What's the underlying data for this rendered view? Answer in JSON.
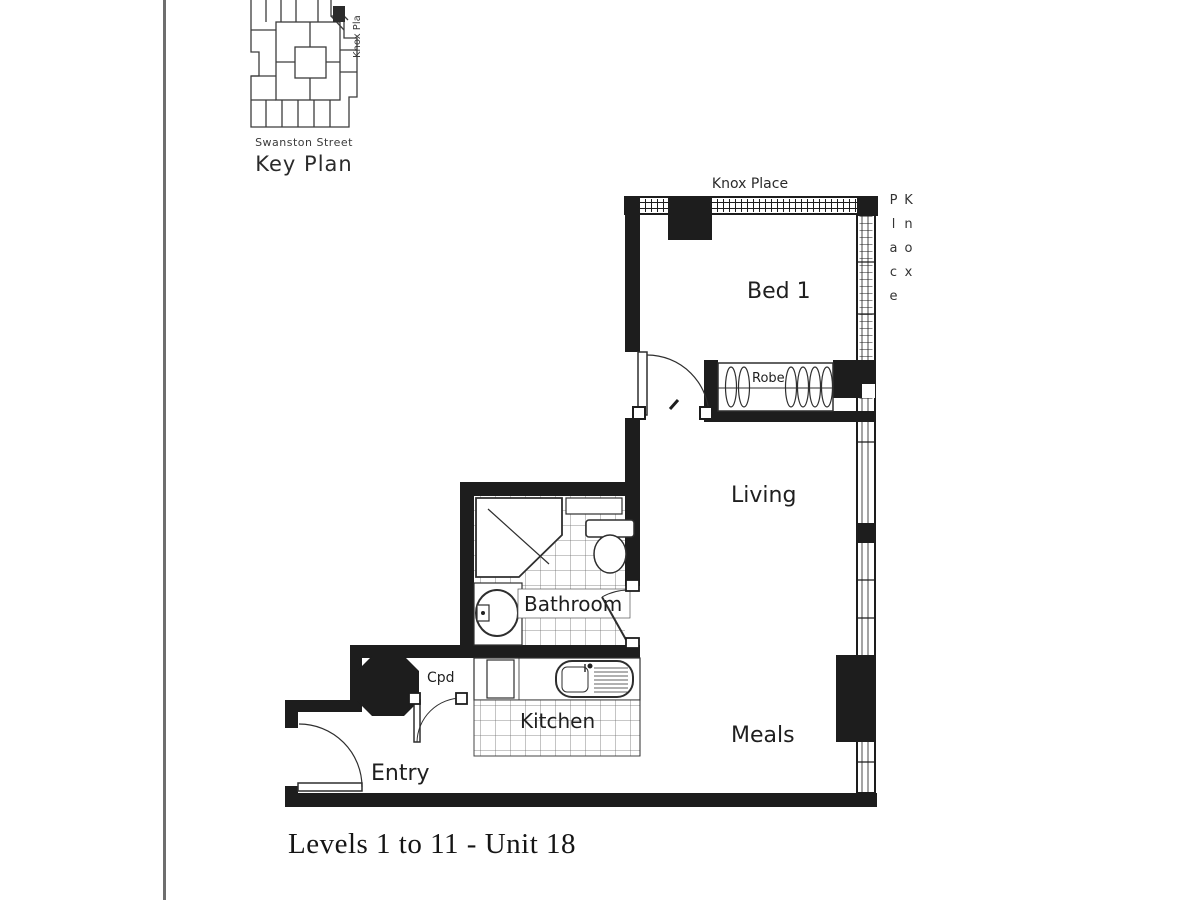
{
  "document": {
    "caption": "Levels 1 to 11 - Unit 18"
  },
  "key_plan": {
    "title": "Key Plan",
    "bottom_street_label": "Swanston Street",
    "side_street_label": "Knox Pla"
  },
  "plan": {
    "street_top_label": "Knox Place",
    "street_right_label": "Knox Place",
    "rooms": {
      "bed1": "Bed 1",
      "living": "Living",
      "meals": "Meals",
      "kitchen": "Kitchen",
      "bathroom": "Bathroom",
      "entry": "Entry",
      "robe": "Robe",
      "cupboard": "Cpd"
    }
  },
  "colors": {
    "ink": "#1d1d1d",
    "thin_line": "#2e2e2e",
    "paper": "#ffffff",
    "scan_edge": "#6e6e6e"
  }
}
